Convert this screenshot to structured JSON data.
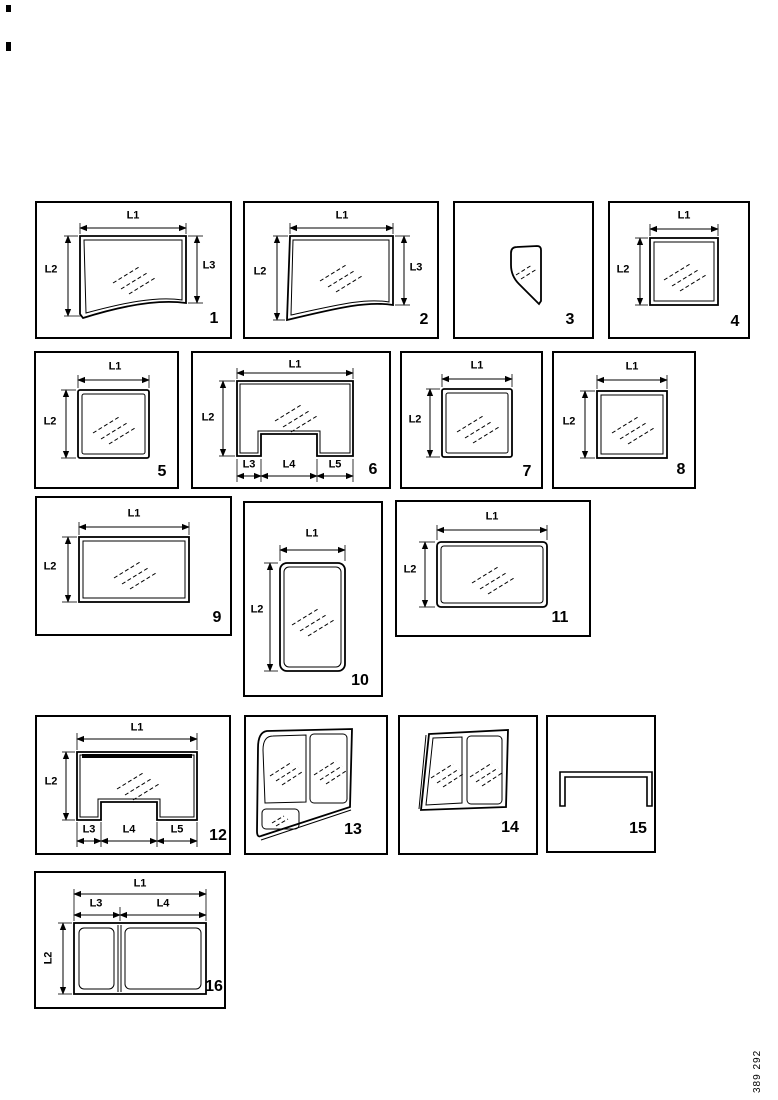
{
  "page": {
    "background_color": "#ffffff",
    "line_color": "#000000",
    "figure_number": "389 292"
  },
  "panels": [
    {
      "number": "1",
      "shape": "door-glass-sloped-bottom",
      "labels": {
        "l1": "L1",
        "l2": "L2",
        "l3": "L3"
      }
    },
    {
      "number": "2",
      "shape": "door-glass-sloped-bottom-mirrored",
      "labels": {
        "l1": "L1",
        "l2": "L2",
        "l3": "L3"
      }
    },
    {
      "number": "3",
      "shape": "quarter-vent-glass",
      "labels": {}
    },
    {
      "number": "4",
      "shape": "square-glass",
      "labels": {
        "l1": "L1",
        "l2": "L2"
      }
    },
    {
      "number": "5",
      "shape": "square-glass",
      "labels": {
        "l1": "L1",
        "l2": "L2"
      }
    },
    {
      "number": "6",
      "shape": "glass-with-bottom-notch",
      "labels": {
        "l1": "L1",
        "l2": "L2",
        "l3": "L3",
        "l4": "L4",
        "l5": "L5"
      }
    },
    {
      "number": "7",
      "shape": "square-glass",
      "labels": {
        "l1": "L1",
        "l2": "L2"
      }
    },
    {
      "number": "8",
      "shape": "square-glass",
      "labels": {
        "l1": "L1",
        "l2": "L2"
      }
    },
    {
      "number": "9",
      "shape": "rect-glass-landscape",
      "labels": {
        "l1": "L1",
        "l2": "L2"
      }
    },
    {
      "number": "10",
      "shape": "rect-glass-portrait",
      "labels": {
        "l1": "L1",
        "l2": "L2"
      }
    },
    {
      "number": "11",
      "shape": "rect-glass-landscape",
      "labels": {
        "l1": "L1",
        "l2": "L2"
      }
    },
    {
      "number": "12",
      "shape": "glass-with-bottom-notch-top-band",
      "labels": {
        "l1": "L1",
        "l2": "L2",
        "l3": "L3",
        "l4": "L4",
        "l5": "L5"
      }
    },
    {
      "number": "13",
      "shape": "sliding-window-assembly-sloped",
      "labels": {}
    },
    {
      "number": "14",
      "shape": "sliding-window-assembly",
      "labels": {}
    },
    {
      "number": "15",
      "shape": "u-channel-profile",
      "labels": {}
    },
    {
      "number": "16",
      "shape": "double-pane-window",
      "labels": {
        "l1": "L1",
        "l2": "L2",
        "l3": "L3",
        "l4": "L4"
      }
    }
  ]
}
